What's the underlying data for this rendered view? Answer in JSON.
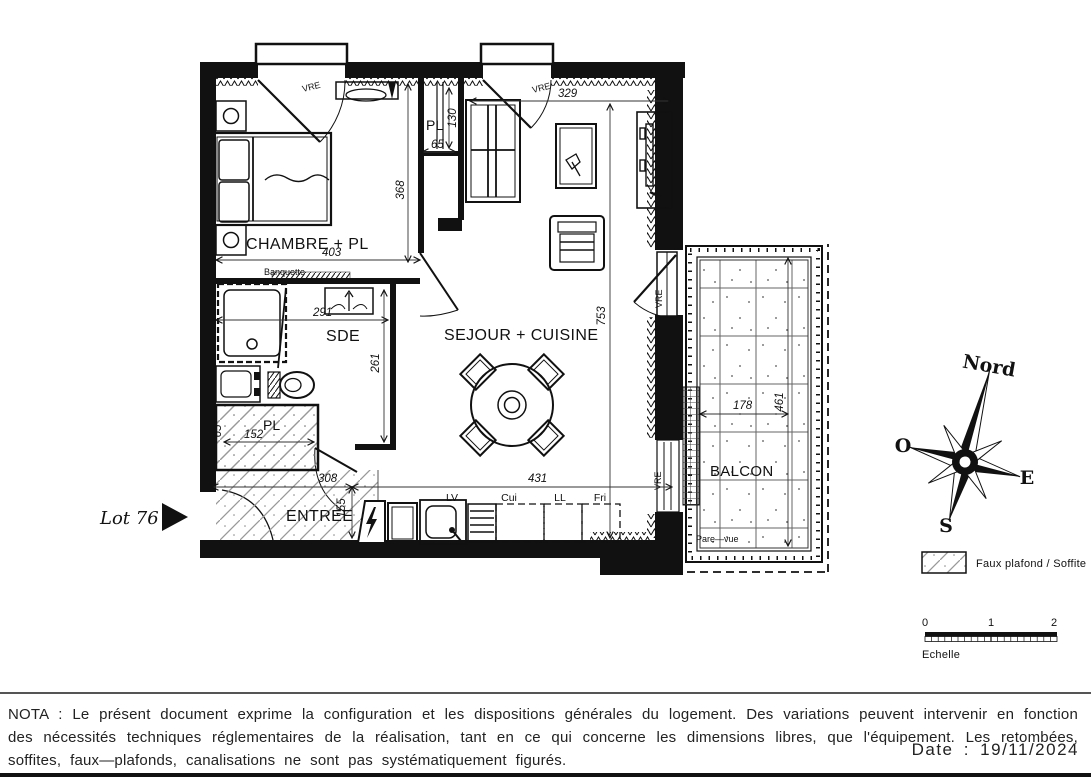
{
  "plan": {
    "lot_label": "Lot 76",
    "rooms": {
      "chambre": "CHAMBRE + PL",
      "sde": "SDE",
      "sejour": "SEJOUR + CUISINE",
      "entree": "ENTREE",
      "balcon": "BALCON",
      "placard": "PL"
    },
    "dims": {
      "chambre_w": "403",
      "chambre_h": "368",
      "sejour_top_w": "329",
      "pl_top_w": "65",
      "pl_top_h": "130",
      "sde_w": "291",
      "sde_h": "261",
      "pl_entree_w": "152",
      "pl_entree_h": "65",
      "entree_w": "308",
      "entree_h": "155",
      "cuisine_w": "431",
      "sejour_h": "753",
      "balcon_w": "178",
      "balcon_h": "461"
    },
    "annotations": {
      "banquette": "Banquette",
      "pare_vue": "Pare—vue",
      "vitrage": "VRE"
    },
    "kitchen": {
      "lv": "LV",
      "cui": "Cui",
      "ll": "LL",
      "fri": "Fri"
    }
  },
  "compass": {
    "north": "Nord",
    "west": "O",
    "east": "E",
    "south": "S"
  },
  "legend": {
    "faux_plafond": "Faux plafond / Soffite"
  },
  "scale_bar": {
    "t0": "0",
    "t1": "1",
    "t2": "2",
    "label": "Echelle"
  },
  "footer": {
    "nota": "NOTA : Le présent document exprime la configuration et les dispositions générales du logement. Des variations peuvent intervenir en fonction des nécessités techniques réglementaires de la réalisation, tant en ce qui concerne les dimensions libres, que l'équipement. Les retombées, soffites, faux—plafonds, canalisations ne sont pas systématiquement figurés.",
    "date": "Date : 19/11/2024"
  }
}
